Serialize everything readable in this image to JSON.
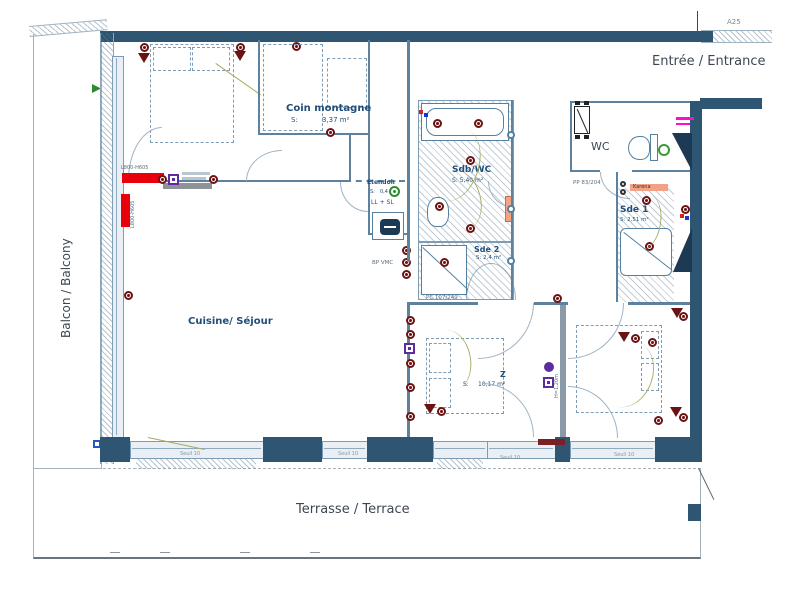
{
  "outdoor": {
    "balcony": "Balcon / Balcony",
    "terrace": "Terrasse / Terrace",
    "entrance": "Entrée / Entrance",
    "wall_ref": "A25"
  },
  "rooms": {
    "coin_montagne": {
      "name": "Coin montagne",
      "s": "S:",
      "area": "3,37 m²"
    },
    "cuisine": {
      "name": "Cuisine/ Séjour"
    },
    "etendoir": {
      "name": "Etendoir",
      "s": "S:",
      "area": "0,4",
      "equip": "LL + SL"
    },
    "sdb": {
      "name": "Sdb/WC",
      "area": "S: 5,40 m²"
    },
    "sde2": {
      "name": "Sde 2",
      "area": "S: 2,4 m²"
    },
    "wc": {
      "name": "WC"
    },
    "sde1": {
      "name": "Sde 1",
      "area": "S: 2,51 m²"
    },
    "chambre": {
      "s": "S:",
      "area": "10,17 m²",
      "zone": "Z"
    }
  },
  "annotations": {
    "radiator": "L800-H605",
    "bp_vmc": "BP VMC",
    "pc": "PC 107/249",
    "pp": "PP 83/204",
    "karena": "Karena",
    "height": "H=1,20m",
    "seuil": "Seuil 10"
  },
  "colors": {
    "wall": "#2e5673",
    "radiator_red": "#e8000d",
    "outlet_maroon": "#6b1212",
    "label_blue": "#1f4e79",
    "karena_salmon": "#f2a285",
    "purple": "#5b2d9e",
    "magenta": "#f711c9",
    "cable_olive": "#a8aa60"
  }
}
